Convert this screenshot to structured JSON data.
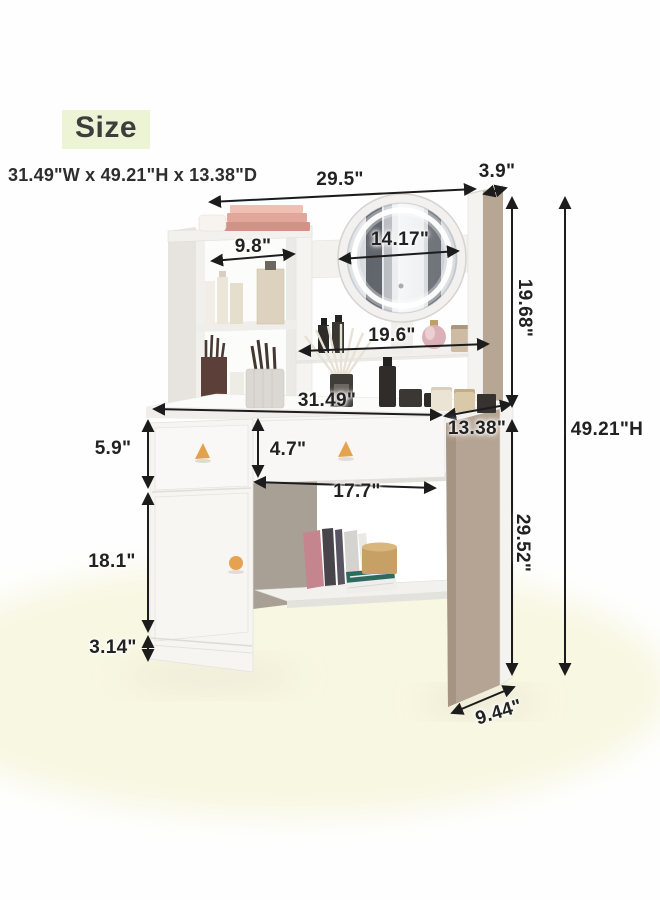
{
  "badge": {
    "label": "Size"
  },
  "summary": {
    "text": "31.49\"W x 49.21\"H x 13.38\"D"
  },
  "dimensions": {
    "top_width": "29.5\"",
    "top_ledge_depth": "3.9\"",
    "hutch_shelf_width": "9.8\"",
    "mirror_diameter": "14.17\"",
    "hutch_height": "19.68\"",
    "middle_shelf_width": "19.6\"",
    "desktop_width": "31.49\"",
    "desktop_depth": "13.38\"",
    "overall_height": "49.21\"H",
    "top_drawer_height": "5.9\"",
    "center_drawer_height": "4.7\"",
    "open_shelf_width": "17.7\"",
    "lower_section_height": "29.52\"",
    "cabinet_door_height": "18.1\"",
    "kick_base_height": "3.14\"",
    "side_panel_depth": "9.44\""
  },
  "colors": {
    "badge_bg": "#edf4d6",
    "label_text": "#222222",
    "dimension_line": "#1c1c1c",
    "furniture_white": "#f6f5f2",
    "panel_beige": "#b5a493",
    "knob_orange": "#e2a24d",
    "floor_glow": "#f8f7e1",
    "mirror_led": "#ffffff"
  }
}
